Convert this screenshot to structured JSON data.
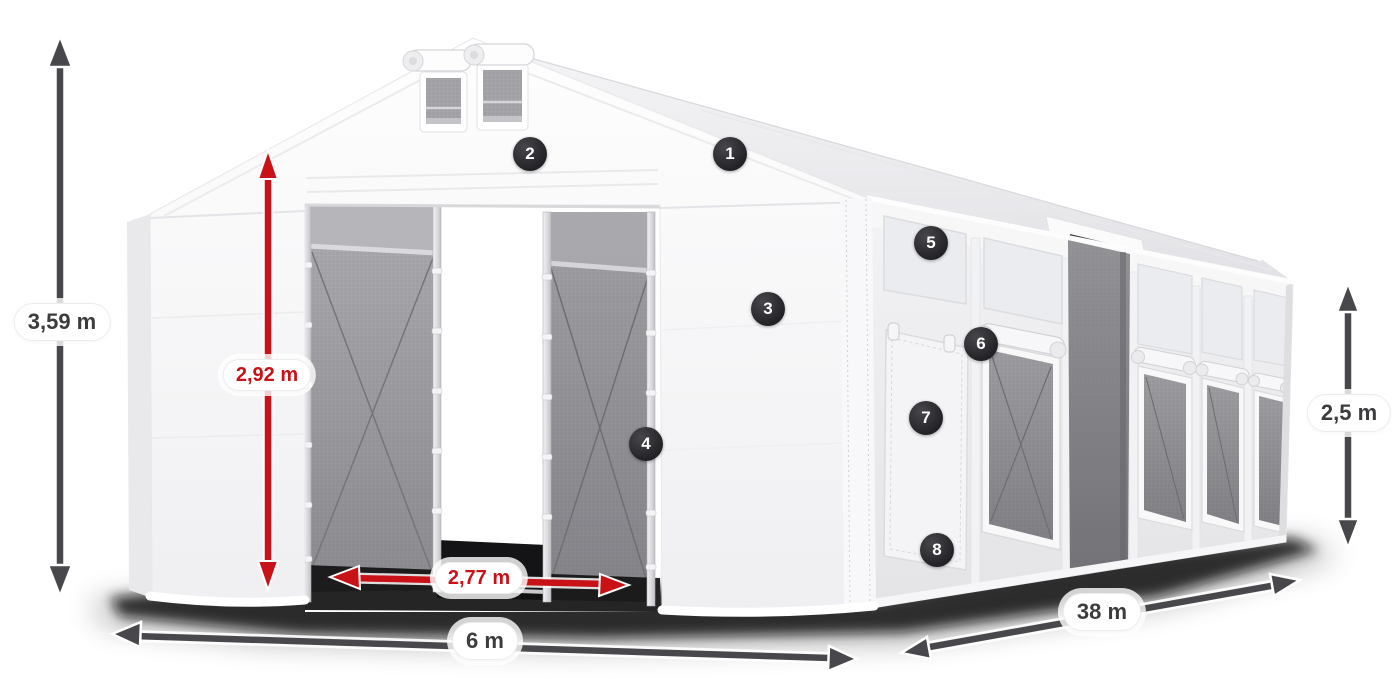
{
  "annotations": {
    "dimensions": [
      {
        "id": "total-height",
        "label": "3,59 m",
        "color": "gray"
      },
      {
        "id": "entrance-height",
        "label": "2,92 m",
        "color": "red"
      },
      {
        "id": "entrance-width",
        "label": "2,77 m",
        "color": "red"
      },
      {
        "id": "tent-width",
        "label": "6 m",
        "color": "gray"
      },
      {
        "id": "tent-length",
        "label": "38 m",
        "color": "gray"
      },
      {
        "id": "side-height",
        "label": "2,5 m",
        "color": "gray"
      }
    ],
    "markers": [
      {
        "label": "1"
      },
      {
        "label": "2"
      },
      {
        "label": "3"
      },
      {
        "label": "4"
      },
      {
        "label": "5"
      },
      {
        "label": "6"
      },
      {
        "label": "7"
      },
      {
        "label": "8"
      }
    ]
  },
  "colors": {
    "dimension_red": "#c91218",
    "dimension_gray": "#48484c",
    "marker_background": "#28282c",
    "label_background": "#ffffff",
    "tent_fabric": "#f4f4f6",
    "mesh_gray": "#97979b"
  }
}
